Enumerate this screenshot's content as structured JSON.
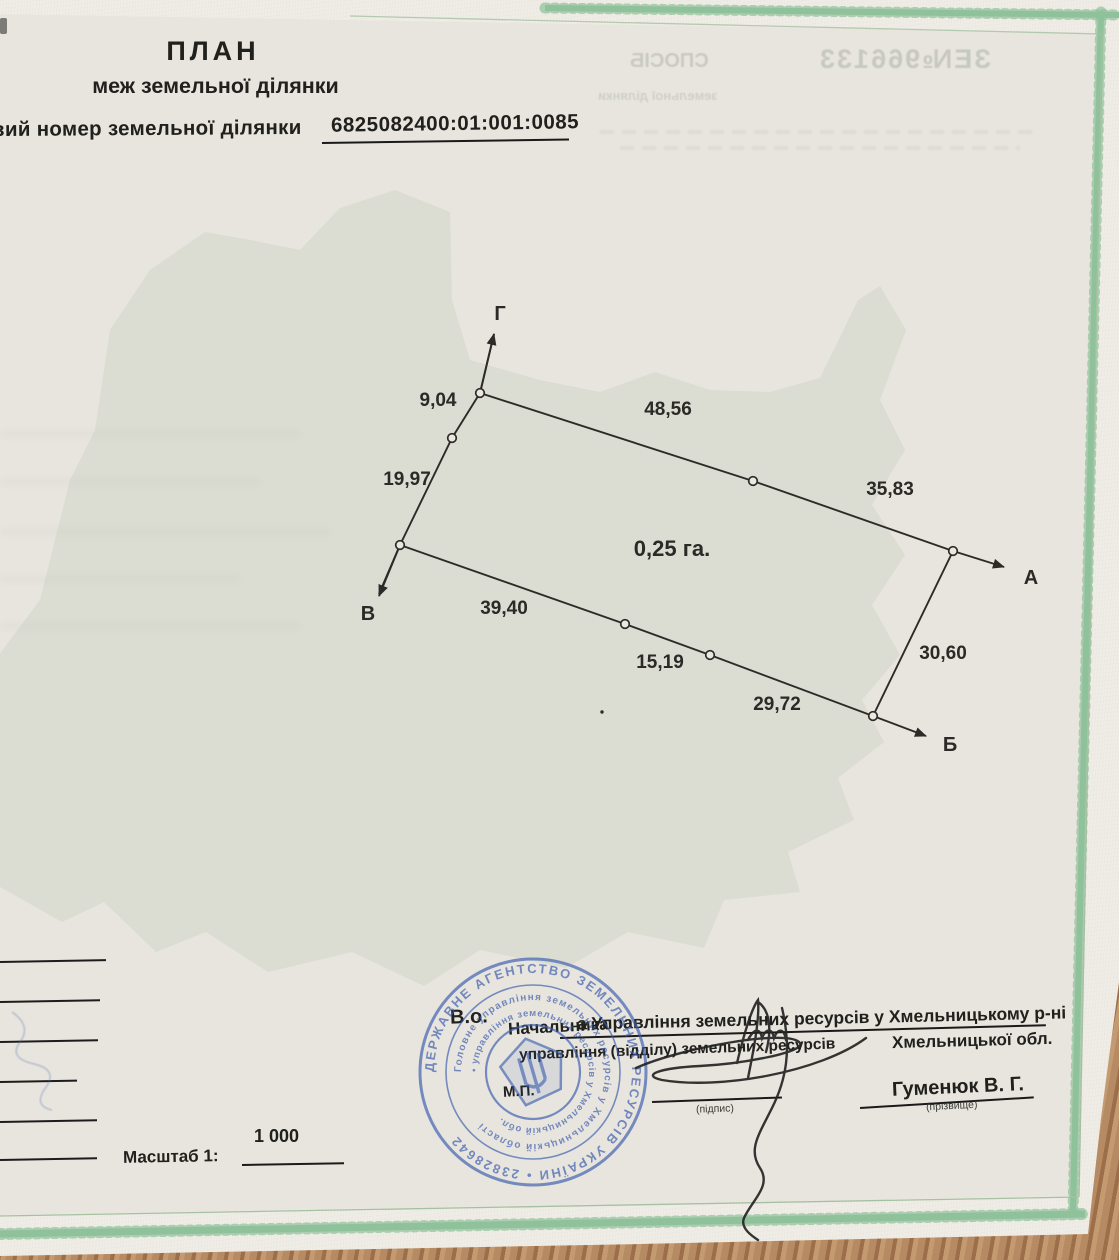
{
  "header": {
    "title": "ПЛАН",
    "subtitle": "меж земельної ділянки",
    "cadastral_label": "вий номер земельної ділянки",
    "cadastral_number": "6825082400:01:001:0085"
  },
  "scale": {
    "label": "Масштаб 1:",
    "value": "1 000"
  },
  "officials": {
    "acting": "В.о.",
    "position": "Начальника",
    "dept_typed": "а Управління земельних ресурсів у Хмельницькому р-ні",
    "dept_printed": "управління (відділу) земельних ресурсів",
    "region": "Хмельницької обл.",
    "sign_caption": "(підпис)",
    "surname": "Гуменюк В. Г.",
    "surname_caption": "(прізвище)",
    "seal_mark": "М.П."
  },
  "stamp": {
    "cx": 533,
    "cy": 1072,
    "color": "#3a5cae",
    "outer_ring": "ДЕРЖАВНЕ АГЕНТСТВО ЗЕМЕЛЬНИХ РЕСУРСІВ УКРАЇНИ • 23828642",
    "ring2": "Головне управління земельних ресурсів у Хмельницькій області",
    "ring3": "• управління земельних ресурсів у Хмельницькій обл."
  },
  "bleedthrough": {
    "word": "СПОСІБ",
    "serial": "ЗЕ№966133",
    "line": "земельної ділянки"
  },
  "diagram": {
    "stroke": "#2d2b28",
    "area_label": {
      "text": "0,25 га.",
      "x": 672,
      "y": 556
    },
    "boundary_polylines": [
      "494,334 480,393 452,438 400,545 379,594",
      "480,393 753,481 953,551",
      "400,545 625,624 710,655 873,716",
      "953,551 873,716"
    ],
    "arrows": [
      {
        "x1": 480,
        "y1": 393,
        "x2": 494,
        "y2": 334
      },
      {
        "x1": 400,
        "y1": 545,
        "x2": 379,
        "y2": 596
      },
      {
        "x1": 953,
        "y1": 551,
        "x2": 1004,
        "y2": 567
      },
      {
        "x1": 873,
        "y1": 716,
        "x2": 926,
        "y2": 736
      }
    ],
    "vertices": [
      [
        480,
        393
      ],
      [
        452,
        438
      ],
      [
        400,
        545
      ],
      [
        753,
        481
      ],
      [
        953,
        551
      ],
      [
        625,
        624
      ],
      [
        710,
        655
      ],
      [
        873,
        716
      ]
    ],
    "point_labels": [
      {
        "text": "Г",
        "x": 500,
        "y": 320
      },
      {
        "text": "А",
        "x": 1031,
        "y": 584
      },
      {
        "text": "Б",
        "x": 950,
        "y": 751
      },
      {
        "text": "В",
        "x": 368,
        "y": 620
      }
    ],
    "measurements": [
      {
        "text": "9,04",
        "x": 438,
        "y": 406
      },
      {
        "text": "19,97",
        "x": 407,
        "y": 485
      },
      {
        "text": "48,56",
        "x": 668,
        "y": 415
      },
      {
        "text": "35,83",
        "x": 890,
        "y": 495
      },
      {
        "text": "39,40",
        "x": 504,
        "y": 614
      },
      {
        "text": "15,19",
        "x": 660,
        "y": 668
      },
      {
        "text": "29,72",
        "x": 777,
        "y": 710
      },
      {
        "text": "30,60",
        "x": 943,
        "y": 659
      }
    ],
    "stray_dot": [
      602,
      712
    ]
  },
  "colors": {
    "paper": "#f0ede7",
    "inner_paper": "#e8e5de",
    "border_green": "#8fc19a",
    "frame_green": "#a6c0a2",
    "table_brown": "#a87c55",
    "stamp_blue": "#3a5cae",
    "ink": "#20201d"
  }
}
